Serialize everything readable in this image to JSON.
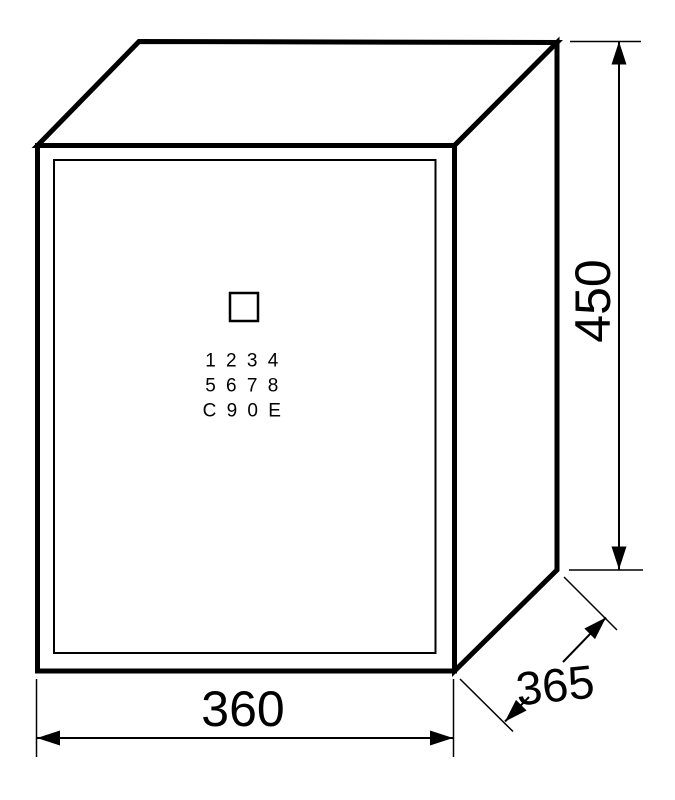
{
  "colors": {
    "ink": "#000000",
    "background": "#ffffff"
  },
  "dimensions": {
    "width": "360",
    "height": "450",
    "depth": "365"
  },
  "keypad": {
    "rows": [
      "1 2 3 4",
      "5 6 7 8",
      "C 9 0 E"
    ]
  }
}
